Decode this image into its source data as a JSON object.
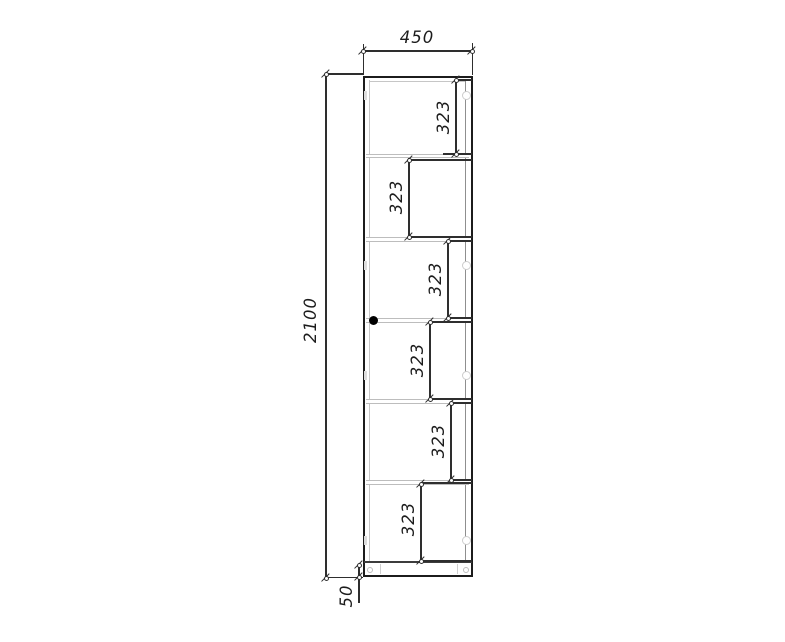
{
  "drawing": {
    "type": "cabinet-elevation",
    "overall_width_mm": "450",
    "overall_height_mm": "2100",
    "plinth_height_mm": "50",
    "shelf_spacings_mm": [
      "323",
      "323",
      "323",
      "323",
      "323",
      "323"
    ]
  },
  "colors": {
    "line": "#1c1c1c",
    "dimension": "#2e2e2e",
    "hidden_line": "#c6c6c6",
    "text": "#1c1c1c",
    "knob": "#000000",
    "background": "#ffffff"
  }
}
